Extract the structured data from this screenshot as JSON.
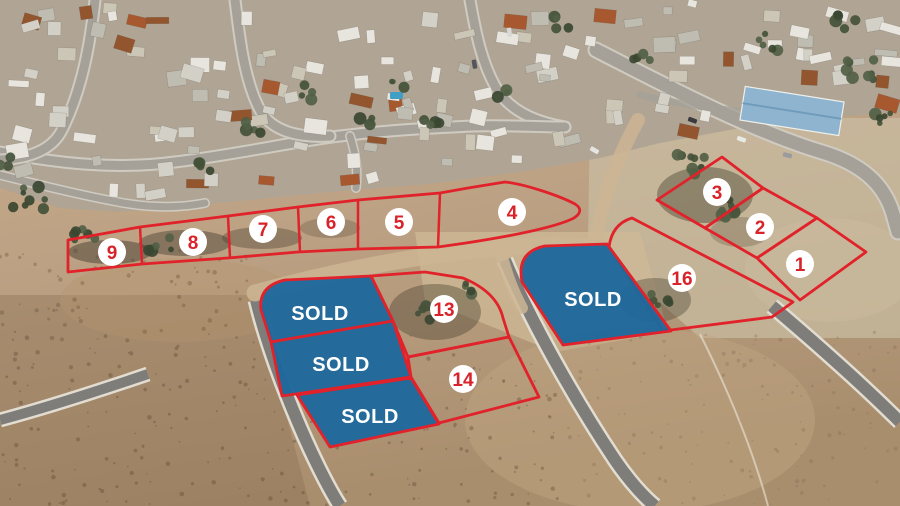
{
  "map": {
    "description_labels": {
      "sold": "SOLD"
    },
    "colors": {
      "outline": "#e1222a",
      "sold_fill": "#1f689c",
      "marker_bg": "#ffffff",
      "marker_text": "#d8232a",
      "sold_text": "#ffffff"
    },
    "plots": {
      "p1": {
        "label": "1"
      },
      "p2": {
        "label": "2"
      },
      "p3": {
        "label": "3"
      },
      "p4": {
        "label": "4"
      },
      "p5": {
        "label": "5"
      },
      "p6": {
        "label": "6"
      },
      "p7": {
        "label": "7"
      },
      "p8": {
        "label": "8"
      },
      "p9": {
        "label": "9"
      },
      "p13": {
        "label": "13"
      },
      "p14": {
        "label": "14"
      },
      "p16": {
        "label": "16"
      }
    },
    "sold_plots": {
      "left_top": {
        "label": "SOLD"
      },
      "left_middle": {
        "label": "SOLD"
      },
      "left_bottom": {
        "label": "SOLD"
      },
      "center": {
        "label": "SOLD"
      }
    }
  }
}
